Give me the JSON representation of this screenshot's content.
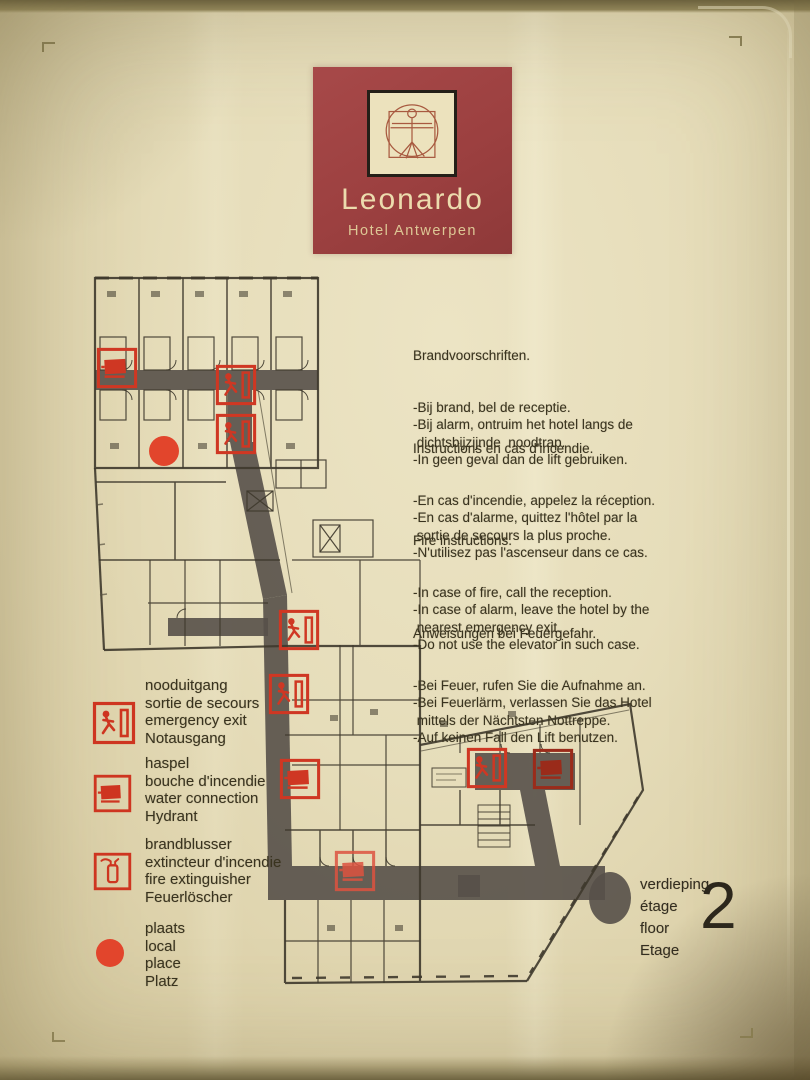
{
  "logo": {
    "brand": "Leonardo",
    "subtitle": "Hotel Antwerpen"
  },
  "instructions": {
    "nl": {
      "title": "Brandvoorschriften.",
      "lines": [
        "-Bij brand, bel de receptie.",
        "-Bij alarm, ontruim het hotel langs de",
        " dichtsbijzijnde  noodtrap.",
        "-In geen geval dan de lift gebruiken."
      ]
    },
    "fr": {
      "title": "Instructions en cas d'incendie.",
      "lines": [
        "-En cas d'incendie, appelez la réception.",
        "-En cas d'alarme, quittez l'hôtel par la",
        " sortie de secours la plus proche.",
        "-N'utilisez pas l'ascenseur dans ce cas."
      ]
    },
    "en": {
      "title": "Fire instructions.",
      "lines": [
        "-In case of fire, call the reception.",
        "-In case of alarm, leave the hotel by the",
        " nearest emergency exit.",
        "-Do not use the elevator in such case."
      ]
    },
    "de": {
      "title": "Anweisungen bei Feuergefahr.",
      "lines": [
        "-Bei Feuer, rufen Sie die Aufnahme an.",
        "-Bei Feuerlärm, verlassen Sie das Hotel",
        " mittels der Nächtsten Nottreppe.",
        "-Auf keinen Fall den Lift benutzen."
      ]
    }
  },
  "legend": {
    "items": [
      {
        "icon": "emergency-exit-icon",
        "labels": [
          "nooduitgang",
          "sortie de secours",
          "emergency exit",
          "Notausgang"
        ]
      },
      {
        "icon": "hose-reel-icon",
        "labels": [
          "haspel",
          "bouche d'incendie",
          "water connection",
          "Hydrant"
        ]
      },
      {
        "icon": "fire-extinguisher-icon",
        "labels": [
          "brandblusser",
          "extincteur d'incendie",
          "fire extinguisher",
          "Feuerlöscher"
        ]
      },
      {
        "icon": "location-circle-icon",
        "labels": [
          "plaats",
          "local",
          "place",
          "Platz"
        ]
      }
    ]
  },
  "floor": {
    "labels": [
      "verdieping",
      "étage",
      "floor",
      "Etage"
    ],
    "number": "2"
  },
  "floorplan": {
    "markers": [
      {
        "type": "hose-reel",
        "x": 37,
        "y": 103
      },
      {
        "type": "emergency-exit",
        "x": 156,
        "y": 120
      },
      {
        "type": "emergency-exit",
        "x": 156,
        "y": 169
      },
      {
        "type": "place-circle",
        "x": 84,
        "y": 186
      },
      {
        "type": "emergency-exit",
        "x": 219,
        "y": 365
      },
      {
        "type": "emergency-exit",
        "x": 209,
        "y": 429
      },
      {
        "type": "hose-reel",
        "x": 220,
        "y": 514
      },
      {
        "type": "hose-reel",
        "x": 275,
        "y": 606,
        "variant": "faded"
      },
      {
        "type": "emergency-exit",
        "x": 407,
        "y": 503
      },
      {
        "type": "hose-reel",
        "x": 473,
        "y": 504,
        "variant": "dark"
      }
    ]
  },
  "colors": {
    "brand_maroon": "#9c4040",
    "safety_red": "#ce3520",
    "corridor_gray": "#575049",
    "wall_dark": "#3e382c",
    "paper_cream": "#e6ddba"
  }
}
